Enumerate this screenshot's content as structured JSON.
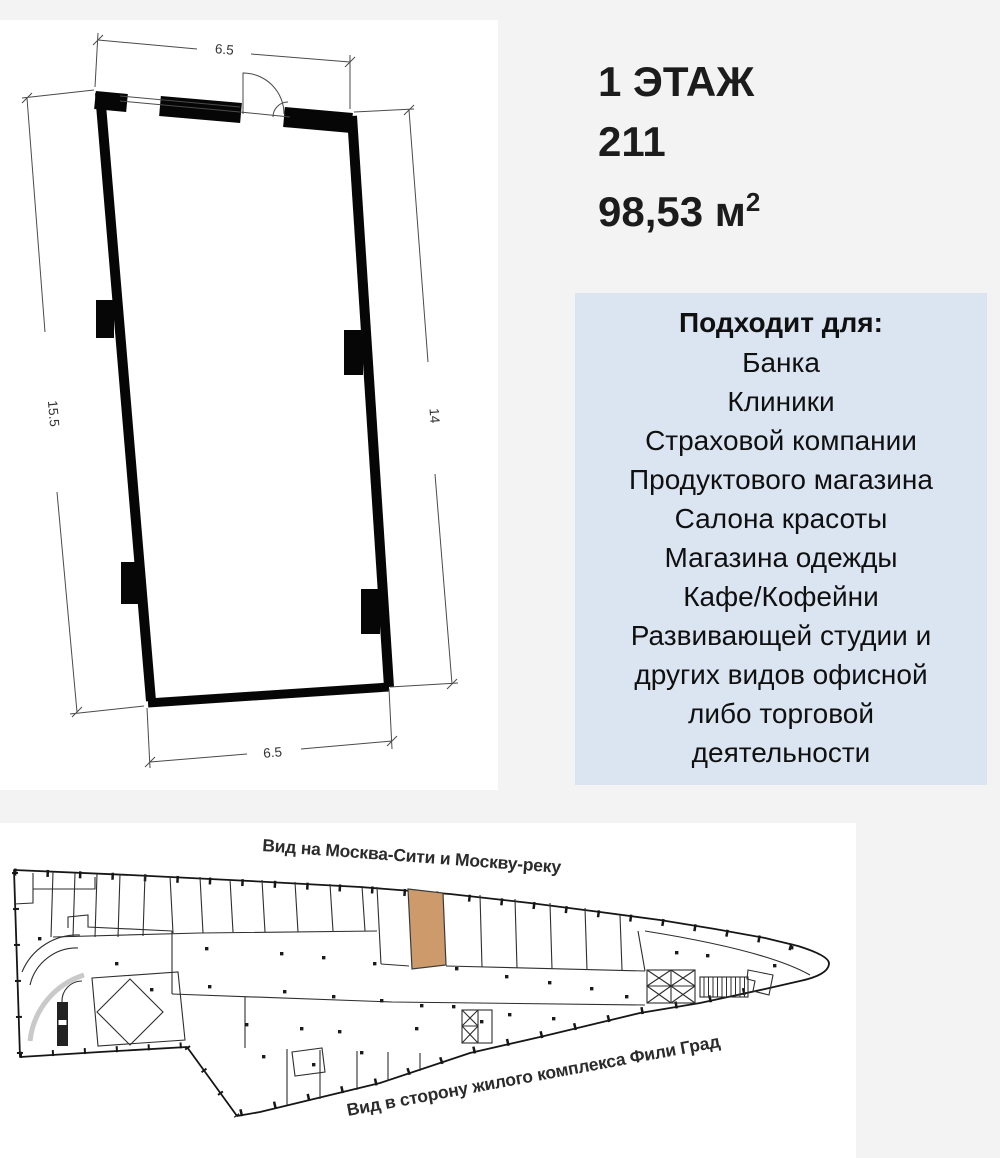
{
  "unit_info": {
    "floor": "1 ЭТАЖ",
    "number": "211",
    "area": "98,53 м",
    "area_sup": "2"
  },
  "floor_plan": {
    "dim_top": "6.5",
    "dim_left": "15.5",
    "dim_right": "14",
    "dim_bottom": "6.5"
  },
  "suitable": {
    "title": "Подходит для:",
    "items": [
      "Банка",
      "Клиники",
      "Страховой компании",
      "Продуктового магазина",
      "Салона красоты",
      "Магазина одежды",
      "Кафе/Кофейни",
      "Развивающей студии  и\nдругих видов офисной\nлибо торговой\nдеятельности"
    ]
  },
  "overview": {
    "label_top": "Вид на Москва-Сити и Москву-реку",
    "label_bottom": "Вид в сторону жилого комплекса Фили Град"
  },
  "colors": {
    "page_bg": "#f3f3f3",
    "panel_bg": "#ffffff",
    "suitable_bg": "#dbe5f1",
    "highlight_unit": "#cd9a6b",
    "text": "#1c1c1c"
  }
}
